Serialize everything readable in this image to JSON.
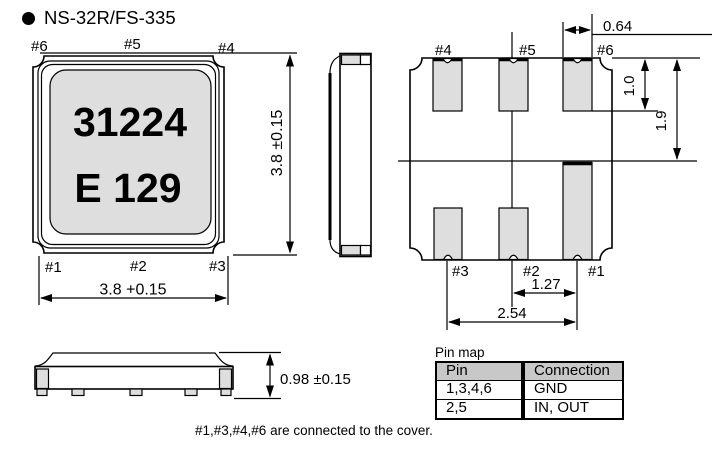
{
  "title": "NS-32R/FS-335",
  "colors": {
    "line": "#000000",
    "pad_fill": "#dedede",
    "table_header_fill": "#c8c8c8",
    "background": "#ffffff"
  },
  "top_view": {
    "marking_line1": "31224",
    "marking_line2": "E 129",
    "pins": {
      "top_left": "#6",
      "top_center": "#5",
      "top_right": "#4",
      "bottom_left": "#1",
      "bottom_center": "#2",
      "bottom_right": "#3"
    },
    "width_dim": "3.8 +0.15",
    "height_dim": "3.8 ±0.15"
  },
  "pad_layout": {
    "pins": {
      "top_left": "#4",
      "top_center": "#5",
      "top_right": "#6",
      "bottom_left": "#3",
      "bottom_center": "#2",
      "bottom_right": "#1"
    },
    "pad_width_dim": "0.64",
    "pad_length_dim": "1.0",
    "edge_to_center_dim": "1.9",
    "pitch_dim": "1.27",
    "span_dim": "2.54"
  },
  "side_profile": {
    "height_dim": "0.98 ±0.15"
  },
  "pin_map": {
    "label": "Pin map",
    "headers": [
      "Pin",
      "Connection"
    ],
    "rows": [
      [
        "1,3,4,6",
        "GND"
      ],
      [
        "2,5",
        "IN, OUT"
      ]
    ]
  },
  "note": "#1,#3,#4,#6 are connected to the cover."
}
